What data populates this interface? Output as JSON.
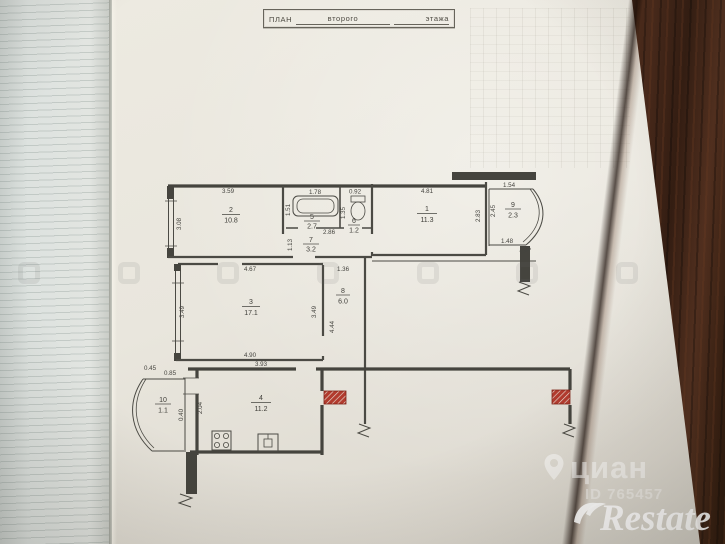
{
  "title_block": {
    "label": "ПЛАН",
    "blank1": "второго",
    "blank2": "этажа"
  },
  "rooms": {
    "r1": {
      "number": "1",
      "area": "11.3"
    },
    "r2": {
      "number": "2",
      "area": "10.8"
    },
    "r3": {
      "number": "3",
      "area": "17.1"
    },
    "r4": {
      "number": "4",
      "area": "11.2"
    },
    "r5": {
      "number": "5",
      "area": "2.7"
    },
    "r6": {
      "number": "6",
      "area": "1.2"
    },
    "r7": {
      "number": "7",
      "area": "3.2"
    },
    "r8": {
      "number": "8",
      "area": "6.0"
    },
    "r9": {
      "number": "9",
      "area": "2.3"
    },
    "r10": {
      "number": "10",
      "area": "1.1"
    }
  },
  "dims": {
    "r2_w": "3.59",
    "r2_h": "3.08",
    "r5_w": "1.78",
    "r5_h": "1.51",
    "r6_w": "0.92",
    "r6_h": "1.35",
    "r7_w": "2.86",
    "r7_h": "1.13",
    "r1_w": "4.81",
    "r1_h": "2.83",
    "r9_w": "1.54",
    "r9_h": "2.45",
    "r9_b1": "1.48",
    "r9_b2": "1.06",
    "r3_w": "4.67",
    "r3_hl": "3.49",
    "r3_hr": "3.49",
    "r3_b": "4.90",
    "r8_w": "1.36",
    "r8_h": "4.44",
    "r4_w": "3.93",
    "r10_d1": "0.45",
    "r10_d2": "0.85",
    "r10_d3": "0.40",
    "r10_d4": "2.04"
  },
  "watermarks": {
    "cian": "циан",
    "cian_id": "ID 765457",
    "restate": "Restate"
  },
  "colors": {
    "ink": "#45443e",
    "red_mark": "#b23b2e",
    "paper": "#e9e6dd",
    "wood": "#3a2113"
  }
}
